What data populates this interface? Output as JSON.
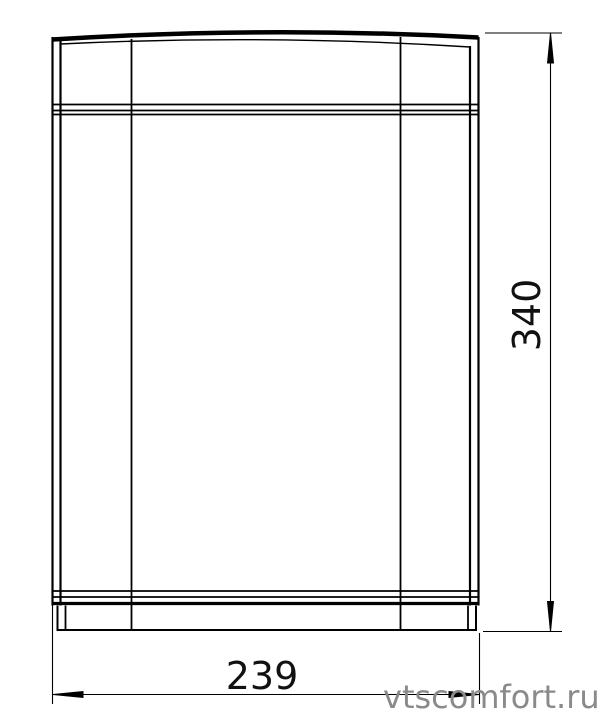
{
  "drawing": {
    "kind": "technical-front-view",
    "dimensions": {
      "height_value": "340",
      "width_value": "239"
    },
    "watermark": {
      "text": "vtscomfort.ru",
      "color": "#8a8a8a"
    },
    "colors": {
      "line": "#000000",
      "background": "#ffffff",
      "dimension_text": "#111111"
    }
  }
}
